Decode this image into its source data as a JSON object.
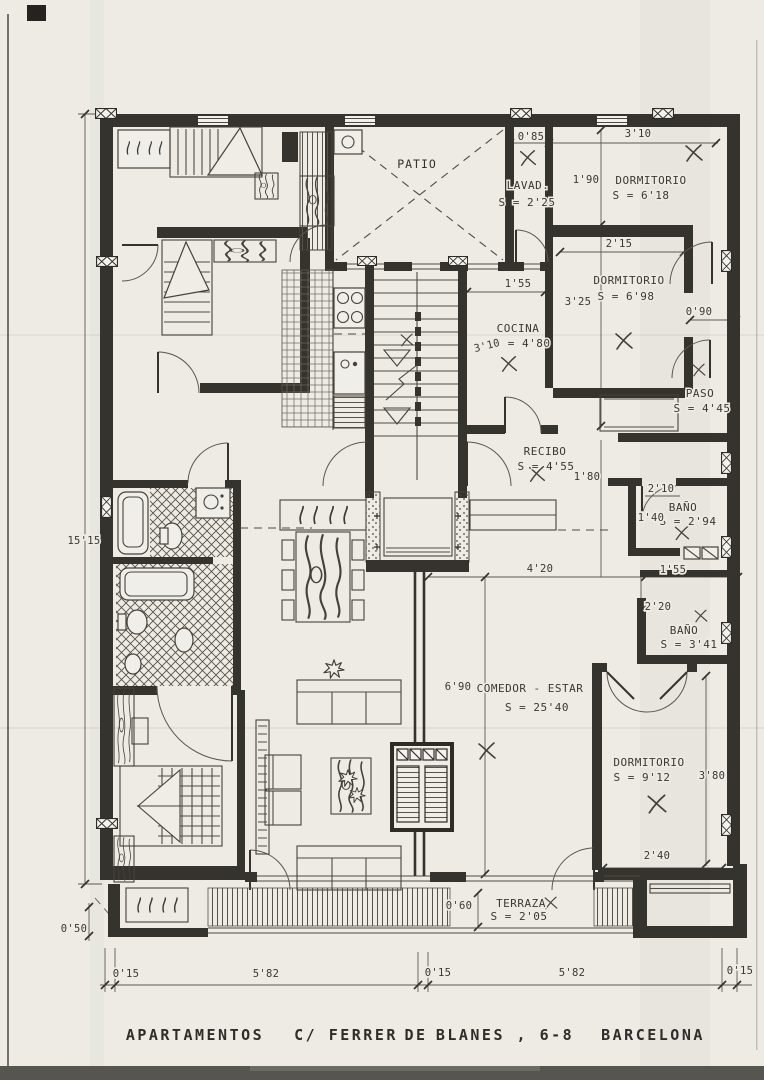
{
  "document": {
    "caption": {
      "project": "APARTAMENTOS",
      "street": "C/ FERRER",
      "connector": "DE",
      "street_number": "BLANES , 6-8",
      "city": "BARCELONA"
    }
  },
  "rooms": {
    "patio": {
      "name": "PATIO",
      "area": ""
    },
    "lavadero": {
      "name": "LAVAD.",
      "area": "S = 2'25"
    },
    "dormitorio_a": {
      "name": "DORMITORIO",
      "area": "S = 6'18"
    },
    "dormitorio_b": {
      "name": "DORMITORIO",
      "area": "S = 6'98"
    },
    "paso": {
      "name": "PASO",
      "area": "S = 4'45"
    },
    "cocina": {
      "name": "COCINA",
      "area": "S = 4'80"
    },
    "recibo": {
      "name": "RECIBO",
      "area": "S = 4'55"
    },
    "bano_a": {
      "name": "BAÑO",
      "area": "S = 2'94"
    },
    "bano_b": {
      "name": "BAÑO",
      "area": "S = 3'41"
    },
    "comedor_estar": {
      "name": "COMEDOR - ESTAR",
      "area": "S = 25'40"
    },
    "dormitorio_c": {
      "name": "DORMITORIO",
      "area": "S = 9'12"
    },
    "terraza": {
      "name": "TERRAZA",
      "area": "S = 2'05"
    }
  },
  "dimensions": {
    "lavad_width": "0'85",
    "dorm_a_width": "3'10",
    "dorm_a_depth": "1'90",
    "dorm_b_width": "2'15",
    "cocina_width": "1'55",
    "dorm_b_depth": "3'25",
    "cocina_depth": "3'10",
    "paso_width": "0'90",
    "recibo_opening": "1'80",
    "bano_a_width": "2'10",
    "bano_a_left": "1'40",
    "facade_left_total": "15'15",
    "comedor_width": "4'20",
    "bano_a_bottom": "1'55",
    "bano_b_depth": "2'20",
    "comedor_depth": "6'90",
    "dorm_c_depth": "3'80",
    "dorm_c_width": "2'40",
    "terraza_depth": "0'60",
    "balcony_depth": "0'50",
    "plot_left_wall": "0'15",
    "plot_left_span": "5'82",
    "plot_mid_wall": "0'15",
    "plot_right_span": "5'82",
    "plot_right_wall": "0'15"
  },
  "colors": {
    "paper": "#edebe4",
    "ink": "#35332d"
  }
}
